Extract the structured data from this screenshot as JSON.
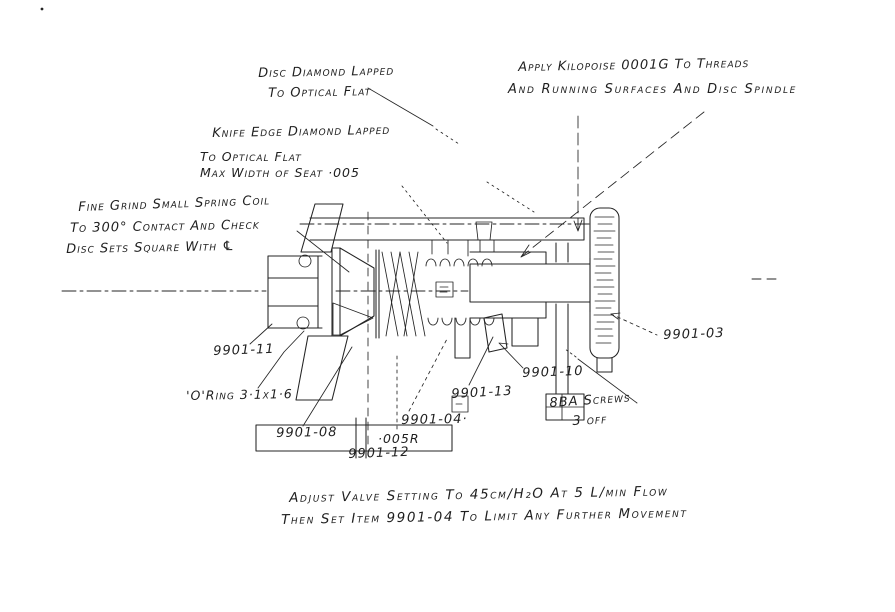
{
  "palette": {
    "ink": "#242424",
    "paper": "#ffffff"
  },
  "notes": {
    "disc_lapped": {
      "line1": "Disc Diamond Lapped",
      "line2": "To Optical Flat"
    },
    "kilopoise": {
      "line1": "Apply Kilopoise 0001G To Threads",
      "line2": "And Running Surfaces And Disc Spindle"
    },
    "knife_edge": {
      "line1": "Knife Edge Diamond Lapped",
      "line2": "To Optical Flat",
      "line3": "Max Width of Seat ·005"
    },
    "fine_grind": {
      "line1": "Fine Grind Small Spring Coil",
      "line2": "To 300° Contact And Check",
      "line3": "Disc Sets Square With ℄"
    },
    "adjustment": {
      "line1": "Adjust Valve Setting To 45cm/H₂O At 5 L/min Flow",
      "line2": "Then Set Item 9901-04 To Limit Any Further Movement"
    }
  },
  "part_labels": {
    "inlet_fitting": "9901-11",
    "o_ring": "'O'Ring 3·1x1·6",
    "body": "9901-08",
    "item_12": "9901-12",
    "radius": "·005R",
    "spindle": "9901-04·",
    "item_13": "9901-13",
    "item_10": "9901-10",
    "screws_line1": "8BA Screws",
    "screws_line2": "3 off",
    "knob": "9901-03"
  }
}
